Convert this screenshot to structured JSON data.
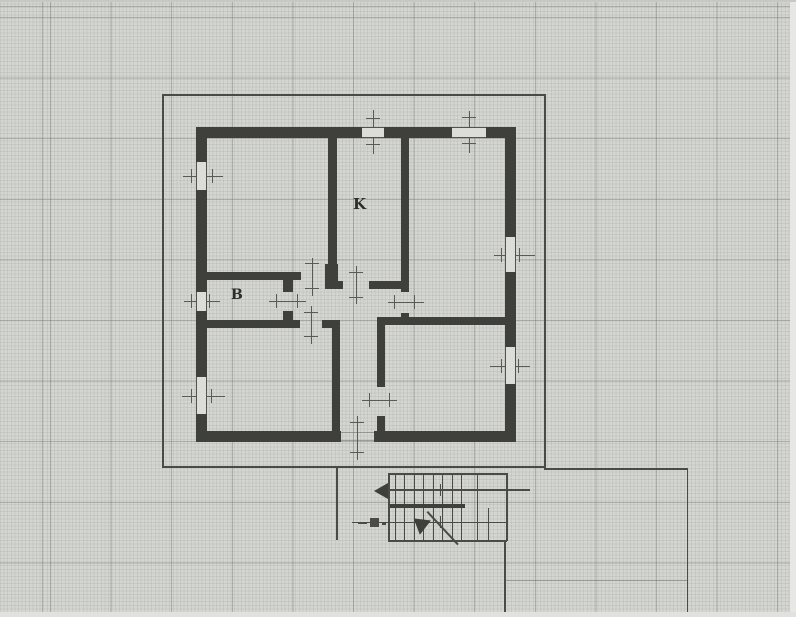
{
  "document": {
    "kind": "scanned architectural floor plan on graph paper"
  },
  "room_labels": [
    {
      "id": "kitchen",
      "text": "K",
      "x": 353,
      "y": 197,
      "size": 15
    },
    {
      "id": "bathroom",
      "text": "B",
      "x": 231,
      "y": 288,
      "size": 14
    }
  ],
  "plan": {
    "colors": {
      "paper": "#d5d6d2",
      "wall": "#3f403b",
      "line": "#4a4b46",
      "grid_major": "#686e66",
      "grid_fine": "#929790"
    },
    "walls": [
      [
        196,
        127,
        166,
        11
      ],
      [
        384,
        127,
        68,
        11
      ],
      [
        486,
        127,
        30,
        11
      ],
      [
        196,
        127,
        11,
        35
      ],
      [
        196,
        190,
        11,
        102
      ],
      [
        196,
        311,
        11,
        66
      ],
      [
        196,
        414,
        11,
        28
      ],
      [
        505,
        127,
        11,
        110
      ],
      [
        505,
        272,
        11,
        75
      ],
      [
        505,
        384,
        11,
        58
      ],
      [
        196,
        431,
        145,
        11
      ],
      [
        374,
        431,
        142,
        11
      ],
      [
        328,
        138,
        9,
        128
      ],
      [
        325,
        264,
        13,
        25
      ],
      [
        401,
        138,
        8,
        154
      ],
      [
        401,
        313,
        8,
        10
      ],
      [
        283,
        277,
        10,
        15
      ],
      [
        283,
        311,
        10,
        12
      ],
      [
        332,
        328,
        8,
        103
      ],
      [
        377,
        317,
        8,
        70
      ],
      [
        377,
        416,
        8,
        15
      ],
      [
        207,
        272,
        94,
        8
      ],
      [
        336,
        281,
        7,
        8
      ],
      [
        369,
        281,
        40,
        8
      ],
      [
        207,
        320,
        93,
        8
      ],
      [
        322,
        320,
        18,
        8
      ],
      [
        384,
        317,
        121,
        8
      ],
      [
        388,
        503.5,
        77,
        4
      ]
    ],
    "window_gaps": [
      {
        "x": 362,
        "y": 127,
        "w": 22,
        "h": 11,
        "orient": "h"
      },
      {
        "x": 452,
        "y": 127,
        "w": 34,
        "h": 11,
        "orient": "h"
      },
      {
        "x": 196,
        "y": 162,
        "w": 11,
        "h": 28,
        "orient": "v"
      },
      {
        "x": 196,
        "y": 292,
        "w": 11,
        "h": 19,
        "orient": "v"
      },
      {
        "x": 196,
        "y": 377,
        "w": 11,
        "h": 37,
        "orient": "v"
      },
      {
        "x": 505,
        "y": 237,
        "w": 11,
        "h": 35,
        "orient": "v"
      },
      {
        "x": 505,
        "y": 347,
        "w": 11,
        "h": 37,
        "orient": "v"
      }
    ],
    "marks": [
      [
        372.5,
        110,
        1,
        44
      ],
      [
        366,
        118,
        14,
        1.2
      ],
      [
        366,
        144,
        14,
        1.2
      ],
      [
        468.5,
        111,
        1,
        42
      ],
      [
        462,
        117,
        14,
        1.2
      ],
      [
        462,
        143,
        14,
        1.2
      ],
      [
        461.5,
        128,
        1,
        9
      ],
      [
        475.5,
        128,
        1,
        9
      ],
      [
        183,
        175.5,
        40,
        1
      ],
      [
        191,
        169,
        1.2,
        14
      ],
      [
        212,
        169,
        1.2,
        14
      ],
      [
        184,
        300.5,
        36,
        1
      ],
      [
        191,
        294,
        1.2,
        14
      ],
      [
        209,
        294,
        1.2,
        14
      ],
      [
        182,
        395.5,
        43,
        1
      ],
      [
        191,
        389,
        1.2,
        14
      ],
      [
        211,
        389,
        1.2,
        14
      ],
      [
        494,
        254.5,
        41,
        1
      ],
      [
        501,
        248,
        1.2,
        14
      ],
      [
        519,
        248,
        1.2,
        14
      ],
      [
        490,
        365.5,
        40,
        1
      ],
      [
        501,
        359,
        1.2,
        14
      ],
      [
        518,
        359,
        1.2,
        14
      ],
      [
        311.5,
        258,
        1,
        38
      ],
      [
        305,
        263,
        14,
        1.2
      ],
      [
        305,
        288,
        14,
        1.2
      ],
      [
        355.5,
        266,
        1,
        38
      ],
      [
        349,
        272,
        14,
        1.2
      ],
      [
        349,
        297,
        14,
        1.2
      ],
      [
        269,
        300.5,
        37,
        1
      ],
      [
        276,
        294,
        1.2,
        14
      ],
      [
        297,
        294,
        1.2,
        14
      ],
      [
        310.5,
        306,
        1,
        38
      ],
      [
        304,
        312,
        14,
        1.2
      ],
      [
        304,
        336,
        14,
        1.2
      ],
      [
        388,
        301.5,
        36,
        1
      ],
      [
        394,
        295,
        1.2,
        14
      ],
      [
        414,
        295,
        1.2,
        14
      ],
      [
        362,
        399.5,
        35,
        1
      ],
      [
        369,
        393,
        1.2,
        14
      ],
      [
        389,
        393,
        1.2,
        14
      ],
      [
        356.5,
        416,
        1,
        44
      ],
      [
        350,
        422,
        14,
        1.2
      ],
      [
        350,
        452,
        14,
        1.2
      ]
    ],
    "lines": [
      [
        162,
        94,
        383,
        1.5
      ],
      [
        162,
        94,
        1.5,
        373
      ],
      [
        162,
        466,
        383,
        1.5
      ],
      [
        544,
        94,
        1.5,
        374
      ],
      [
        544,
        468,
        144,
        1.5
      ],
      [
        686.5,
        468,
        1.5,
        149
      ],
      [
        336,
        466,
        1.5,
        74
      ],
      [
        504,
        541,
        1.5,
        76
      ],
      [
        388,
        473,
        119,
        1.5
      ],
      [
        388,
        473,
        1.5,
        68
      ],
      [
        388,
        539.5,
        119,
        2
      ],
      [
        505.5,
        473,
        2,
        68
      ],
      [
        477,
        473,
        1.2,
        68
      ],
      [
        488,
        508,
        1.2,
        33
      ],
      [
        378,
        489,
        152,
        1.8
      ],
      [
        352,
        521.5,
        155,
        1.2
      ],
      [
        439.5,
        484,
        1.2,
        12
      ],
      [
        439.5,
        516,
        1.2,
        12
      ],
      [
        370,
        518,
        9,
        9
      ],
      [
        358,
        522,
        9,
        1.5
      ],
      [
        382,
        523,
        4,
        1.5
      ]
    ],
    "faint_lines": [
      [
        505,
        580,
        182,
        1
      ],
      [
        341,
        431.5,
        33,
        1
      ],
      [
        341,
        440,
        33,
        1
      ]
    ],
    "treads": {
      "xs": [
        395,
        404,
        414,
        423,
        433,
        442,
        452,
        461
      ],
      "w": 1.3,
      "upper": {
        "y": 473,
        "h": 31
      },
      "lower": {
        "y": 508,
        "h": 32
      }
    },
    "arrows": [
      {
        "type": "left",
        "x": 374,
        "y": 483
      },
      {
        "type": "diag",
        "x": 412,
        "y": 514
      }
    ],
    "diag_line": {
      "x": 428,
      "y": 511,
      "len": 45,
      "angle": 47
    }
  }
}
